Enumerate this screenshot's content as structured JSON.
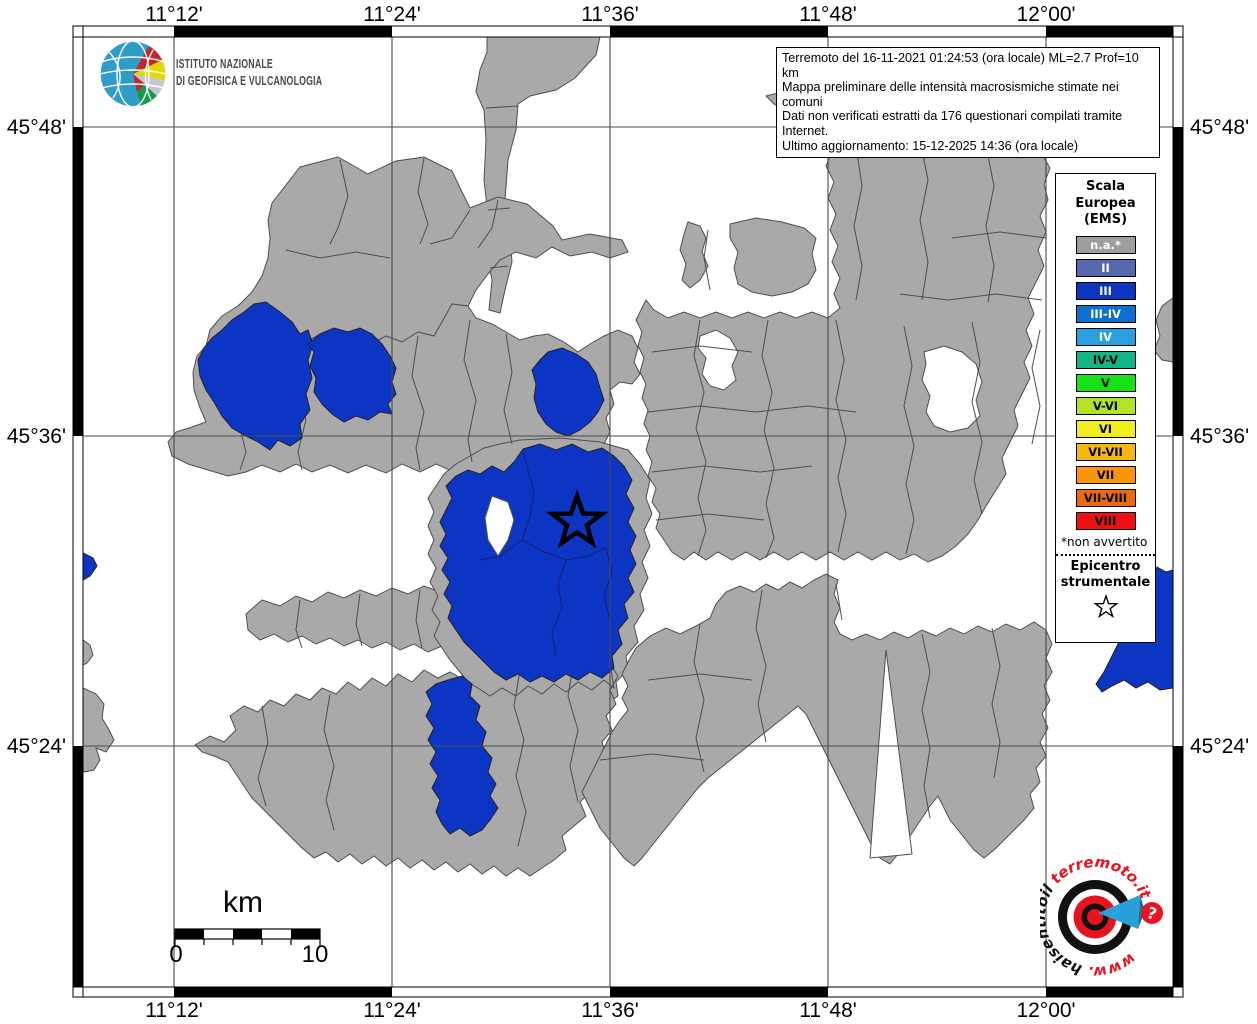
{
  "info_box": {
    "lines": [
      "Terremoto del 16-11-2021 01:24:53 (ora locale) ML=2.7 Prof=10 km",
      "Mappa preliminare delle intensità macrosismiche stimate nei comuni",
      "Dati non verificati estratti da 176 questionari compilati tramite Internet.",
      "Ultimo aggiornamento: 15-12-2025 14:36 (ora locale)"
    ]
  },
  "ingv": {
    "name_line1": "ISTITUTO NAZIONALE",
    "name_line2": "DI GEOFISICA E VULCANOLOGIA"
  },
  "axes": {
    "top": [
      "11°12'",
      "11°24'",
      "11°36'",
      "11°48'",
      "12°00'"
    ],
    "bottom": [
      "11°12'",
      "11°24'",
      "11°36'",
      "11°48'",
      "12°00'"
    ],
    "left": [
      "45°48'",
      "45°36'",
      "45°24'"
    ],
    "right": [
      "45°48'",
      "45°36'",
      "45°24'"
    ]
  },
  "legend": {
    "title_lines": [
      "Scala",
      "Europea",
      "(EMS)"
    ],
    "items": [
      {
        "label": "n.a.*",
        "color": "#9e9e9e",
        "text": "#ffffff"
      },
      {
        "label": "II",
        "color": "#5568b0",
        "text": "#ffffff"
      },
      {
        "label": "III",
        "color": "#0d35c4",
        "text": "#ffffff"
      },
      {
        "label": "III-IV",
        "color": "#0d6fd0",
        "text": "#ffffff"
      },
      {
        "label": "IV",
        "color": "#2aa0e0",
        "text": "#ffffff"
      },
      {
        "label": "IV-V",
        "color": "#12b586",
        "text": "#000000"
      },
      {
        "label": "V",
        "color": "#16e316",
        "text": "#000000"
      },
      {
        "label": "V-VI",
        "color": "#b2e423",
        "text": "#000000"
      },
      {
        "label": "VI",
        "color": "#f2ee1e",
        "text": "#000000"
      },
      {
        "label": "VI-VII",
        "color": "#f4b80e",
        "text": "#000000"
      },
      {
        "label": "VII",
        "color": "#fb9407",
        "text": "#000000"
      },
      {
        "label": "VII-VIII",
        "color": "#ed6a0b",
        "text": "#000000"
      },
      {
        "label": "VIII",
        "color": "#ee1111",
        "text": "#000000"
      }
    ],
    "footnote": "*non avvertito",
    "epicenter_lines": [
      "Epicentro",
      "strumentale"
    ]
  },
  "scale_bar": {
    "unit": "km",
    "start": "0",
    "end": "10"
  },
  "map": {
    "colors": {
      "municipality": "#a9a9a9",
      "intensity_iii": "#0d35c4",
      "grid": "#4a4a4a"
    }
  },
  "watermark": {
    "prefix": "www.",
    "middle": "haisentitoil",
    "suffix": "terremoto.it",
    "question_mark": "?"
  }
}
